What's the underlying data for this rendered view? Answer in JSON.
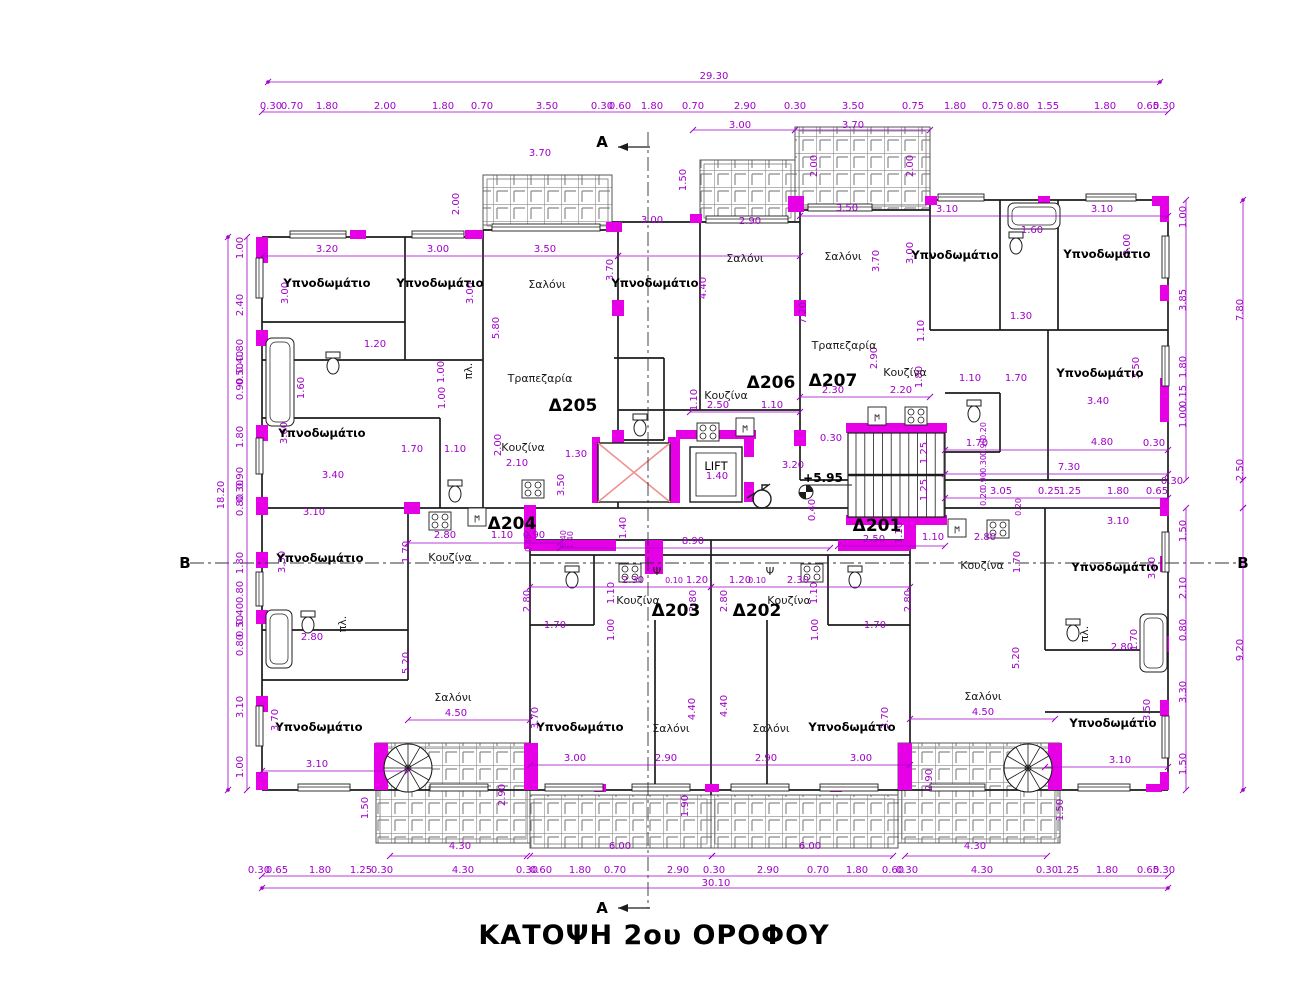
{
  "title": {
    "text": "ΚΑΤΟΨΗ 2ου ΟΡΟΦΟΥ"
  },
  "colors": {
    "dim": "#a000c8",
    "wall_fill": "#e500e5",
    "line": "#1c1c1c",
    "lightwell_cross": "#f09090",
    "hatch": "#8a8a8a"
  },
  "lift_label": "LIFT",
  "level_marker": "+5.95",
  "section_markers": {
    "top": "A",
    "bottom": "A",
    "left": "B",
    "right": "B"
  },
  "apartments": [
    {
      "id": "Δ205",
      "x": 573,
      "y": 411
    },
    {
      "id": "Δ206",
      "x": 771,
      "y": 388
    },
    {
      "id": "Δ207",
      "x": 833,
      "y": 386
    },
    {
      "id": "Δ204",
      "x": 512,
      "y": 529
    },
    {
      "id": "Δ203",
      "x": 676,
      "y": 616
    },
    {
      "id": "Δ202",
      "x": 757,
      "y": 616
    },
    {
      "id": "Δ201",
      "x": 877,
      "y": 531
    }
  ],
  "rooms": [
    {
      "t": "Υπνοδωμάτιο",
      "x": 327,
      "y": 287,
      "b": 1
    },
    {
      "t": "Υπνοδωμάτιο",
      "x": 440,
      "y": 287,
      "b": 1
    },
    {
      "t": "Υπνοδωμάτιο",
      "x": 655,
      "y": 287,
      "b": 1
    },
    {
      "t": "Υπνοδωμάτιο",
      "x": 955,
      "y": 259,
      "b": 1
    },
    {
      "t": "Υπνοδωμάτιο",
      "x": 1107,
      "y": 258,
      "b": 1
    },
    {
      "t": "Υπνοδωμάτιο",
      "x": 322,
      "y": 437,
      "b": 1
    },
    {
      "t": "Υπνοδωμάτιο",
      "x": 1100,
      "y": 377,
      "b": 1
    },
    {
      "t": "Υπνοδωμάτιο",
      "x": 320,
      "y": 562,
      "b": 1
    },
    {
      "t": "Υπνοδωμάτιο",
      "x": 1115,
      "y": 571,
      "b": 1
    },
    {
      "t": "Υπνοδωμάτιο",
      "x": 319,
      "y": 731,
      "b": 1
    },
    {
      "t": "Υπνοδωμάτιο",
      "x": 580,
      "y": 731,
      "b": 1
    },
    {
      "t": "Υπνοδωμάτιο",
      "x": 852,
      "y": 731,
      "b": 1
    },
    {
      "t": "Υπνοδωμάτιο",
      "x": 1113,
      "y": 727,
      "b": 1
    },
    {
      "t": "Σαλόνι",
      "x": 547,
      "y": 288
    },
    {
      "t": "Σαλόνι",
      "x": 745,
      "y": 262
    },
    {
      "t": "Σαλόνι",
      "x": 843,
      "y": 260
    },
    {
      "t": "Σαλόνι",
      "x": 453,
      "y": 701
    },
    {
      "t": "Σαλόνι",
      "x": 671,
      "y": 732
    },
    {
      "t": "Σαλόνι",
      "x": 771,
      "y": 732
    },
    {
      "t": "Σαλόνι",
      "x": 983,
      "y": 700
    },
    {
      "t": "Κουζίνα",
      "x": 523,
      "y": 451
    },
    {
      "t": "Κουζίνα",
      "x": 726,
      "y": 399
    },
    {
      "t": "Κουζίνα",
      "x": 905,
      "y": 376
    },
    {
      "t": "Κουζίνα",
      "x": 450,
      "y": 561
    },
    {
      "t": "Κουζίνα",
      "x": 638,
      "y": 604
    },
    {
      "t": "Κουζίνα",
      "x": 789,
      "y": 604
    },
    {
      "t": "Κουζίνα",
      "x": 982,
      "y": 569
    },
    {
      "t": "Τραπεζαρία",
      "x": 540,
      "y": 382
    },
    {
      "t": "Τραπεζαρία",
      "x": 844,
      "y": 349
    },
    {
      "t": "Ψ",
      "x": 657,
      "y": 575
    },
    {
      "t": "Ψ",
      "x": 770,
      "y": 575
    },
    {
      "t": "πλ.",
      "x": 472,
      "y": 371,
      "r": 1
    },
    {
      "t": "πλ.",
      "x": 346,
      "y": 624,
      "r": 1
    },
    {
      "t": "πλ.",
      "x": 1088,
      "y": 634,
      "r": 1
    }
  ],
  "dimensions": [
    [
      "29.30",
      714,
      79
    ],
    [
      "3.00",
      740,
      128
    ],
    [
      "3.70",
      853,
      128
    ],
    [
      "0.30",
      271,
      109
    ],
    [
      "0.70",
      292,
      109
    ],
    [
      "1.80",
      327,
      109
    ],
    [
      "2.00",
      385,
      109
    ],
    [
      "1.80",
      443,
      109
    ],
    [
      "0.70",
      482,
      109
    ],
    [
      "3.50",
      547,
      109
    ],
    [
      "0.30",
      602,
      109
    ],
    [
      "0.60",
      620,
      109
    ],
    [
      "1.80",
      652,
      109
    ],
    [
      "0.70",
      693,
      109
    ],
    [
      "2.90",
      745,
      109
    ],
    [
      "0.30",
      795,
      109
    ],
    [
      "3.50",
      853,
      109
    ],
    [
      "0.75",
      913,
      109
    ],
    [
      "1.80",
      955,
      109
    ],
    [
      "0.75",
      993,
      109
    ],
    [
      "0.80",
      1018,
      109
    ],
    [
      "1.55",
      1048,
      109
    ],
    [
      "1.80",
      1105,
      109
    ],
    [
      "0.65",
      1148,
      109
    ],
    [
      "0.30",
      1164,
      109
    ],
    [
      "0.30",
      259,
      873
    ],
    [
      "0.65",
      277,
      873
    ],
    [
      "1.80",
      320,
      873
    ],
    [
      "1.25",
      361,
      873
    ],
    [
      "0.30",
      382,
      873
    ],
    [
      "4.30",
      463,
      873
    ],
    [
      "0.30",
      527,
      873
    ],
    [
      "0.60",
      541,
      873
    ],
    [
      "1.80",
      580,
      873
    ],
    [
      "0.70",
      615,
      873
    ],
    [
      "2.90",
      678,
      873
    ],
    [
      "0.30",
      714,
      873
    ],
    [
      "2.90",
      768,
      873
    ],
    [
      "0.70",
      818,
      873
    ],
    [
      "1.80",
      857,
      873
    ],
    [
      "0.60",
      893,
      873
    ],
    [
      "0.30",
      907,
      873
    ],
    [
      "4.30",
      982,
      873
    ],
    [
      "0.30",
      1047,
      873
    ],
    [
      "1.25",
      1068,
      873
    ],
    [
      "1.80",
      1107,
      873
    ],
    [
      "0.65",
      1148,
      873
    ],
    [
      "0.30",
      1164,
      873
    ],
    [
      "4.30",
      460,
      849
    ],
    [
      "6.00",
      620,
      849
    ],
    [
      "6.00",
      810,
      849
    ],
    [
      "4.30",
      975,
      849
    ],
    [
      "30.10",
      716,
      886
    ],
    [
      "1.00",
      243,
      248,
      1
    ],
    [
      "2.40",
      243,
      305,
      1
    ],
    [
      "0.80",
      243,
      350,
      1
    ],
    [
      "0.40",
      243,
      362,
      1
    ],
    [
      "0.50",
      243,
      374,
      1
    ],
    [
      "0.90",
      243,
      389,
      1
    ],
    [
      "1.80",
      243,
      437,
      1
    ],
    [
      "0.90",
      243,
      478,
      1
    ],
    [
      "0.30",
      243,
      491,
      1
    ],
    [
      "0.80",
      243,
      505,
      1
    ],
    [
      "1.80",
      243,
      563,
      1
    ],
    [
      "0.80",
      243,
      592,
      1
    ],
    [
      "0.40",
      243,
      614,
      1
    ],
    [
      "0.50",
      243,
      626,
      1
    ],
    [
      "0.80",
      243,
      645,
      1
    ],
    [
      "3.10",
      243,
      707,
      1
    ],
    [
      "1.00",
      243,
      767,
      1
    ],
    [
      "18.20",
      224,
      495,
      1
    ],
    [
      "1.00",
      1186,
      217,
      1
    ],
    [
      "3.85",
      1186,
      300,
      1
    ],
    [
      "1.80",
      1186,
      367,
      1
    ],
    [
      "0.15",
      1186,
      396,
      1
    ],
    [
      "1.00",
      1186,
      417,
      1
    ],
    [
      "1.50",
      1186,
      531,
      1
    ],
    [
      "2.10",
      1186,
      588,
      1
    ],
    [
      "0.80",
      1186,
      630,
      1
    ],
    [
      "3.30",
      1186,
      692,
      1
    ],
    [
      "1.50",
      1186,
      764,
      1
    ],
    [
      "7.80",
      1243,
      310,
      1
    ],
    [
      "2.50",
      1243,
      470,
      1
    ],
    [
      "9.20",
      1243,
      650,
      1
    ],
    [
      "3.20",
      327,
      252
    ],
    [
      "3.00",
      438,
      252
    ],
    [
      "3.50",
      545,
      252
    ],
    [
      "3.50",
      847,
      211
    ],
    [
      "3.10",
      947,
      212
    ],
    [
      "3.10",
      1102,
      212
    ],
    [
      "3.00",
      652,
      223
    ],
    [
      "2.90",
      750,
      224
    ],
    [
      "3.70",
      540,
      156
    ],
    [
      "2.00",
      459,
      204,
      1
    ],
    [
      "1.50",
      686,
      180,
      1
    ],
    [
      "2.00",
      817,
      166,
      1
    ],
    [
      "2.00",
      913,
      166,
      1
    ],
    [
      "1.60",
      1032,
      233
    ],
    [
      "1.30",
      1021,
      319
    ],
    [
      "3.00",
      288,
      293,
      1
    ],
    [
      "3.00",
      473,
      293,
      1
    ],
    [
      "3.70",
      613,
      270,
      1
    ],
    [
      "3.70",
      879,
      261,
      1
    ],
    [
      "3.00",
      913,
      253,
      1
    ],
    [
      "3.00",
      1130,
      245,
      1
    ],
    [
      "5.80",
      499,
      328,
      1
    ],
    [
      "4.40",
      706,
      288,
      1
    ],
    [
      "7.20",
      806,
      313,
      1
    ],
    [
      "1.20",
      375,
      347
    ],
    [
      "1.60",
      304,
      388,
      1
    ],
    [
      "1.00",
      444,
      372,
      1
    ],
    [
      "1.00",
      445,
      398,
      1
    ],
    [
      "2.90",
      877,
      358,
      1
    ],
    [
      "1.10",
      924,
      331,
      1
    ],
    [
      "1.80",
      922,
      377,
      1
    ],
    [
      "2.50",
      718,
      408
    ],
    [
      "1.10",
      772,
      408
    ],
    [
      "2.30",
      833,
      393
    ],
    [
      "2.20",
      901,
      393
    ],
    [
      "1.10",
      970,
      381
    ],
    [
      "1.70",
      1016,
      381
    ],
    [
      "3.50",
      1139,
      368,
      1
    ],
    [
      "3.40",
      1098,
      404
    ],
    [
      "3.60",
      287,
      433,
      1
    ],
    [
      "1.70",
      412,
      452
    ],
    [
      "1.10",
      455,
      452
    ],
    [
      "2.00",
      501,
      445,
      1
    ],
    [
      "2.10",
      517,
      466
    ],
    [
      "3.40",
      333,
      478
    ],
    [
      "1.30",
      576,
      457
    ],
    [
      "3.50",
      564,
      485,
      1
    ],
    [
      "1.10",
      697,
      400,
      1
    ],
    [
      "0.30",
      831,
      441
    ],
    [
      "3.20",
      793,
      468
    ],
    [
      "0.40",
      815,
      510,
      1
    ],
    [
      "1.25",
      927,
      453,
      1
    ],
    [
      "1.25",
      927,
      490,
      1
    ],
    [
      "1.70",
      977,
      446
    ],
    [
      "4.80",
      1102,
      445
    ],
    [
      "0.30",
      1154,
      446
    ],
    [
      "7.30",
      1069,
      470
    ],
    [
      "0.30",
      1172,
      484
    ],
    [
      "3.05",
      1001,
      494
    ],
    [
      "0.25",
      1049,
      494
    ],
    [
      "1.25",
      1070,
      494
    ],
    [
      "1.80",
      1118,
      494
    ],
    [
      "0.65",
      1157,
      494
    ],
    [
      "0.20",
      986,
      431,
      1,
      8
    ],
    [
      "0.90",
      986,
      447,
      1,
      8
    ],
    [
      "0.30",
      986,
      464,
      1,
      8
    ],
    [
      "0.90",
      986,
      481,
      1,
      8
    ],
    [
      "0.20",
      986,
      497,
      1,
      8
    ],
    [
      "1.40",
      717,
      479
    ],
    [
      "1.40",
      626,
      528,
      1
    ],
    [
      "8.90",
      693,
      544
    ],
    [
      "2.50",
      874,
      542
    ],
    [
      "1.10",
      902,
      533,
      1
    ],
    [
      "1.10",
      933,
      540
    ],
    [
      "0.40",
      566,
      539,
      1,
      8
    ],
    [
      "0.30",
      531,
      543,
      1,
      8
    ],
    [
      "1.40",
      573,
      540,
      1,
      8
    ],
    [
      "3.10",
      314,
      515
    ],
    [
      "2.80",
      445,
      538
    ],
    [
      "1.10",
      502,
      538
    ],
    [
      "0.90",
      534,
      538
    ],
    [
      "1.70",
      409,
      552,
      1
    ],
    [
      "3.30",
      285,
      562,
      1
    ],
    [
      "2.80",
      312,
      640
    ],
    [
      "5.20",
      409,
      663,
      1
    ],
    [
      "4.50",
      456,
      716
    ],
    [
      "3.70",
      278,
      720,
      1
    ],
    [
      "3.10",
      317,
      767
    ],
    [
      "1.50",
      368,
      808,
      1
    ],
    [
      "2.90",
      505,
      795,
      1
    ],
    [
      "2.30",
      633,
      583
    ],
    [
      "0.10",
      674,
      583,
      0,
      8
    ],
    [
      "1.20",
      697,
      583
    ],
    [
      "1.20",
      740,
      583
    ],
    [
      "0.10",
      757,
      583,
      0,
      8
    ],
    [
      "2.30",
      798,
      583
    ],
    [
      "1.10",
      614,
      593,
      1
    ],
    [
      "1.10",
      817,
      593,
      1
    ],
    [
      "2.80",
      530,
      601,
      1
    ],
    [
      "2.80",
      696,
      601,
      1
    ],
    [
      "2.80",
      727,
      601,
      1
    ],
    [
      "2.80",
      911,
      601,
      1
    ],
    [
      "1.00",
      614,
      630,
      1
    ],
    [
      "1.00",
      818,
      630,
      1
    ],
    [
      "1.70",
      555,
      628
    ],
    [
      "1.70",
      875,
      628
    ],
    [
      "3.70",
      538,
      718,
      1
    ],
    [
      "3.70",
      888,
      718,
      1
    ],
    [
      "4.40",
      695,
      709,
      1
    ],
    [
      "4.40",
      727,
      706,
      1
    ],
    [
      "3.00",
      575,
      761
    ],
    [
      "2.90",
      666,
      761
    ],
    [
      "2.90",
      766,
      761
    ],
    [
      "3.00",
      861,
      761
    ],
    [
      "1.90",
      688,
      806,
      1
    ],
    [
      "0.20",
      1021,
      507,
      1,
      8
    ],
    [
      "2.80",
      985,
      540
    ],
    [
      "1.70",
      1020,
      562,
      1
    ],
    [
      "3.10",
      1118,
      524
    ],
    [
      "3.30",
      1155,
      568,
      1
    ],
    [
      "2.80",
      1122,
      650
    ],
    [
      "1.70",
      1137,
      640,
      1
    ],
    [
      "5.20",
      1019,
      658,
      1
    ],
    [
      "4.50",
      983,
      715
    ],
    [
      "3.50",
      1150,
      710,
      1
    ],
    [
      "3.10",
      1120,
      763
    ],
    [
      "2.90",
      932,
      780,
      1
    ],
    [
      "1.50",
      1063,
      810,
      1
    ]
  ]
}
